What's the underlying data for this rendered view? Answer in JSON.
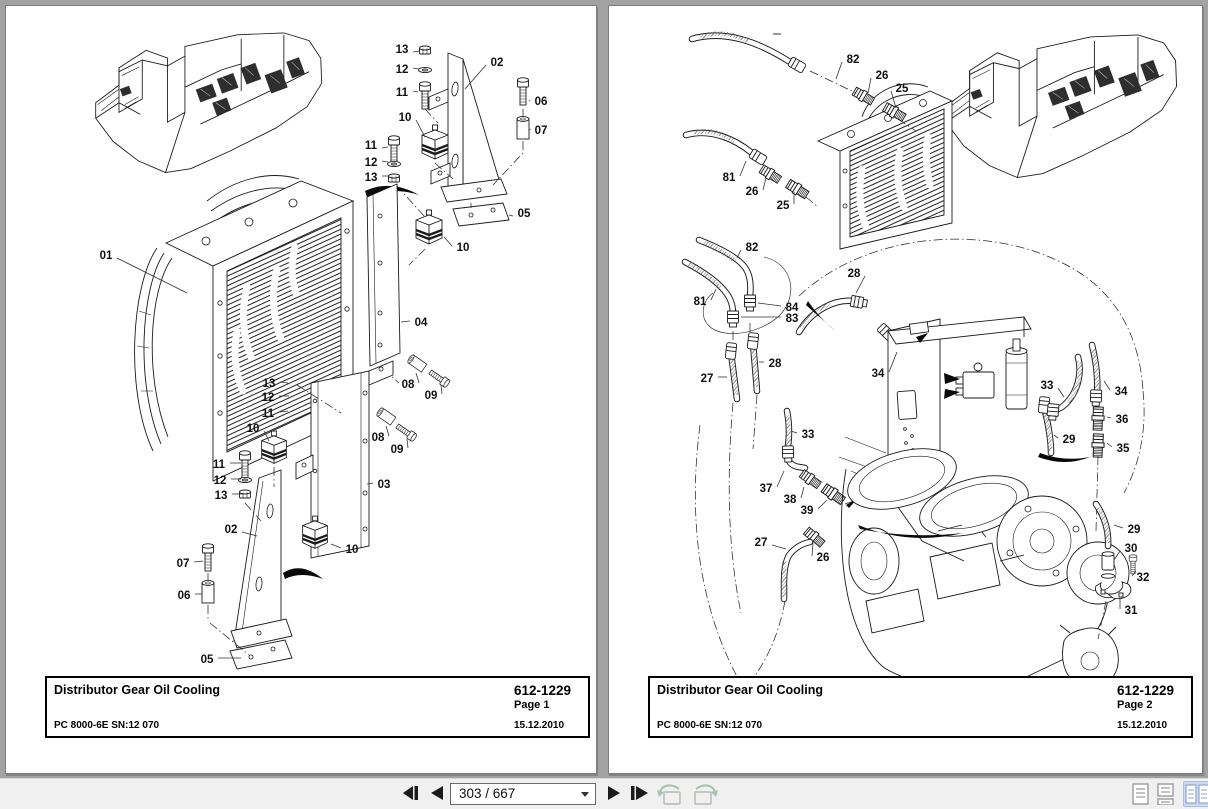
{
  "viewer": {
    "background_color": "#a2a2a2",
    "toolbar": {
      "page_field": "303 / 667",
      "selected_view_mode": "facing-pages",
      "selected_view_bg": "#cddaf2",
      "icons": [
        "first-page-icon",
        "previous-page-icon",
        "page-number-combobox",
        "next-page-icon",
        "last-page-icon",
        "previous-view-icon",
        "next-view-icon",
        "single-page-view-icon",
        "continuous-view-icon",
        "facing-pages-view-icon"
      ]
    }
  },
  "pages": [
    {
      "footer": {
        "title": "Distributor Gear Oil Cooling",
        "doc_number": "612-1229",
        "page_label": "Page 1",
        "model": "PC 8000-6E SN:12 070",
        "date": "15.12.2010"
      },
      "callouts": [
        {
          "t": "13",
          "x": 401,
          "y": 48,
          "x2": 419,
          "y2": 50
        },
        {
          "t": "12",
          "x": 401,
          "y": 68,
          "x2": 418,
          "y2": 68
        },
        {
          "t": "11",
          "x": 401,
          "y": 91,
          "x2": 417,
          "y2": 91
        },
        {
          "t": "02",
          "x": 496,
          "y": 61,
          "x2": 464,
          "y2": 88
        },
        {
          "t": "06",
          "x": 540,
          "y": 100,
          "x2": 528,
          "y2": 100
        },
        {
          "t": "07",
          "x": 540,
          "y": 129,
          "x2": 529,
          "y2": 129
        },
        {
          "t": "10",
          "x": 404,
          "y": 116,
          "x2": 424,
          "y2": 136
        },
        {
          "t": "11",
          "x": 370,
          "y": 144,
          "x2": 387,
          "y2": 146
        },
        {
          "t": "12",
          "x": 370,
          "y": 161,
          "x2": 387,
          "y2": 161
        },
        {
          "t": "13",
          "x": 370,
          "y": 176,
          "x2": 388,
          "y2": 175
        },
        {
          "t": "05",
          "x": 523,
          "y": 212,
          "x2": 508,
          "y2": 214
        },
        {
          "t": "10",
          "x": 462,
          "y": 246,
          "x2": 443,
          "y2": 236
        },
        {
          "t": "01",
          "x": 105,
          "y": 254,
          "x2": 186,
          "y2": 292
        },
        {
          "t": "04",
          "x": 420,
          "y": 321,
          "x2": 400,
          "y2": 321
        },
        {
          "t": "13",
          "x": 268,
          "y": 382,
          "x2": 287,
          "y2": 382
        },
        {
          "t": "12",
          "x": 267,
          "y": 396,
          "x2": 288,
          "y2": 395
        },
        {
          "t": "11",
          "x": 267,
          "y": 412,
          "x2": 287,
          "y2": 410
        },
        {
          "t": "08",
          "x": 407,
          "y": 383,
          "x2": 415,
          "y2": 372
        },
        {
          "t": "09",
          "x": 430,
          "y": 394,
          "x2": 440,
          "y2": 384
        },
        {
          "t": "08",
          "x": 377,
          "y": 436,
          "x2": 385,
          "y2": 425
        },
        {
          "t": "09",
          "x": 396,
          "y": 448,
          "x2": 406,
          "y2": 438
        },
        {
          "t": "03",
          "x": 383,
          "y": 483,
          "x2": 366,
          "y2": 483
        },
        {
          "t": "11",
          "x": 218,
          "y": 463,
          "x2": 240,
          "y2": 462
        },
        {
          "t": "12",
          "x": 219,
          "y": 479,
          "x2": 240,
          "y2": 478
        },
        {
          "t": "13",
          "x": 220,
          "y": 494,
          "x2": 241,
          "y2": 493
        },
        {
          "t": "02",
          "x": 230,
          "y": 528,
          "x2": 256,
          "y2": 535
        },
        {
          "t": "07",
          "x": 182,
          "y": 562,
          "x2": 202,
          "y2": 560
        },
        {
          "t": "06",
          "x": 183,
          "y": 594,
          "x2": 201,
          "y2": 593
        },
        {
          "t": "05",
          "x": 206,
          "y": 658,
          "x2": 240,
          "y2": 657
        },
        {
          "t": "10",
          "x": 252,
          "y": 427,
          "x2": 268,
          "y2": 440
        },
        {
          "t": "10",
          "x": 351,
          "y": 548,
          "x2": 330,
          "y2": 543
        }
      ]
    },
    {
      "footer": {
        "title": "Distributor Gear Oil Cooling",
        "doc_number": "612-1229",
        "page_label": "Page 2",
        "model": "PC 8000-6E SN:12 070",
        "date": "15.12.2010"
      },
      "callouts": [
        {
          "t": "82",
          "x": 853,
          "y": 58,
          "x2": 836,
          "y2": 78
        },
        {
          "t": "26",
          "x": 882,
          "y": 74,
          "x2": 868,
          "y2": 92
        },
        {
          "t": "25",
          "x": 902,
          "y": 87,
          "x2": 896,
          "y2": 107
        },
        {
          "t": "81",
          "x": 729,
          "y": 176,
          "x2": 746,
          "y2": 160
        },
        {
          "t": "26",
          "x": 752,
          "y": 190,
          "x2": 766,
          "y2": 177
        },
        {
          "t": "25",
          "x": 783,
          "y": 204,
          "x2": 794,
          "y2": 191
        },
        {
          "t": "82",
          "x": 752,
          "y": 246,
          "x2": 737,
          "y2": 257
        },
        {
          "t": "81",
          "x": 700,
          "y": 300,
          "x2": 716,
          "y2": 288
        },
        {
          "t": "84",
          "x": 792,
          "y": 306,
          "x2": 758,
          "y2": 302
        },
        {
          "t": "83",
          "x": 792,
          "y": 317,
          "x2": 741,
          "y2": 316
        },
        {
          "t": "28",
          "x": 854,
          "y": 272,
          "x2": 856,
          "y2": 292
        },
        {
          "t": "27",
          "x": 707,
          "y": 377,
          "x2": 727,
          "y2": 376
        },
        {
          "t": "28",
          "x": 775,
          "y": 362,
          "x2": 759,
          "y2": 361
        },
        {
          "t": "34",
          "x": 878,
          "y": 372,
          "x2": 897,
          "y2": 351
        },
        {
          "t": "33",
          "x": 808,
          "y": 433,
          "x2": 791,
          "y2": 430
        },
        {
          "t": "37",
          "x": 766,
          "y": 487,
          "x2": 784,
          "y2": 470
        },
        {
          "t": "38",
          "x": 790,
          "y": 498,
          "x2": 804,
          "y2": 486
        },
        {
          "t": "39",
          "x": 807,
          "y": 509,
          "x2": 827,
          "y2": 499
        },
        {
          "t": "27",
          "x": 761,
          "y": 541,
          "x2": 786,
          "y2": 548
        },
        {
          "t": "26",
          "x": 823,
          "y": 556,
          "x2": 813,
          "y2": 542
        },
        {
          "t": "33",
          "x": 1047,
          "y": 384,
          "x2": 1064,
          "y2": 396
        },
        {
          "t": "34",
          "x": 1121,
          "y": 390,
          "x2": 1104,
          "y2": 380
        },
        {
          "t": "36",
          "x": 1122,
          "y": 418,
          "x2": 1107,
          "y2": 416
        },
        {
          "t": "35",
          "x": 1123,
          "y": 447,
          "x2": 1107,
          "y2": 442
        },
        {
          "t": "29",
          "x": 1069,
          "y": 438,
          "x2": 1054,
          "y2": 434
        },
        {
          "t": "29",
          "x": 1134,
          "y": 528,
          "x2": 1114,
          "y2": 524
        },
        {
          "t": "30",
          "x": 1131,
          "y": 547,
          "x2": 1114,
          "y2": 559
        },
        {
          "t": "32",
          "x": 1143,
          "y": 576,
          "x2": 1136,
          "y2": 570
        },
        {
          "t": "31",
          "x": 1131,
          "y": 609,
          "x2": 1120,
          "y2": 597
        }
      ]
    }
  ]
}
